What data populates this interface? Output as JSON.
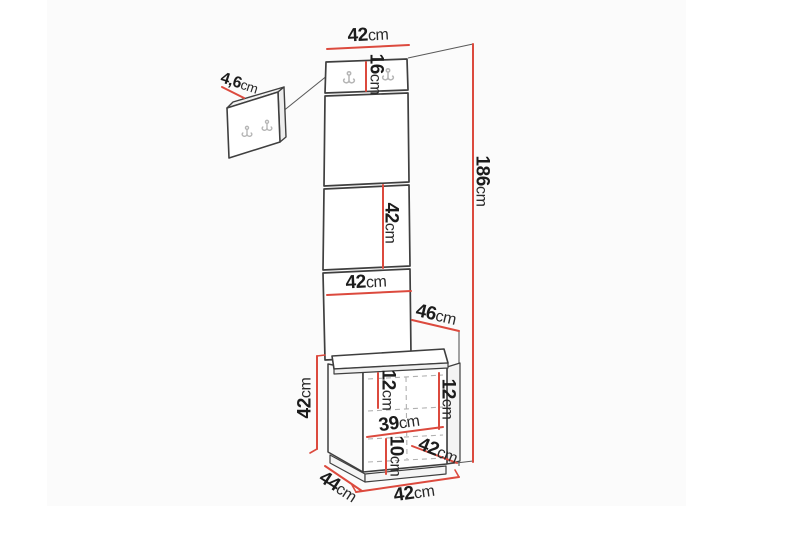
{
  "diagram": {
    "unit_system": "cm",
    "dimensions": [
      {
        "id": "panel-width-top",
        "value": "42",
        "unit": "cm"
      },
      {
        "id": "hook-panel-height",
        "value": "16",
        "unit": "cm"
      },
      {
        "id": "wall-panel-thickness",
        "value": "4,6",
        "unit": "cm"
      },
      {
        "id": "middle-panel-height",
        "value": "42",
        "unit": "cm"
      },
      {
        "id": "panel-width-lower",
        "value": "42",
        "unit": "cm"
      },
      {
        "id": "unit-depth-upper",
        "value": "46",
        "unit": "cm"
      },
      {
        "id": "total-height",
        "value": "186",
        "unit": "cm"
      },
      {
        "id": "bench-height",
        "value": "42",
        "unit": "cm"
      },
      {
        "id": "drawer-height-left",
        "value": "12",
        "unit": "cm"
      },
      {
        "id": "drawer-height-right",
        "value": "12",
        "unit": "cm"
      },
      {
        "id": "internal-width",
        "value": "39",
        "unit": "cm"
      },
      {
        "id": "plinth-height",
        "value": "10",
        "unit": "cm"
      },
      {
        "id": "drawer-front-width",
        "value": "42",
        "unit": "cm"
      },
      {
        "id": "bench-depth",
        "value": "44",
        "unit": "cm"
      },
      {
        "id": "bench-width",
        "value": "42",
        "unit": "cm"
      }
    ],
    "colors": {
      "dimension_line": "#dc4a3e",
      "outline": "#3f3f3f",
      "hook": "#b5b5b5",
      "dashed": "#b0b0b0",
      "text": "#1c1c1c",
      "background": "#ffffff"
    }
  }
}
